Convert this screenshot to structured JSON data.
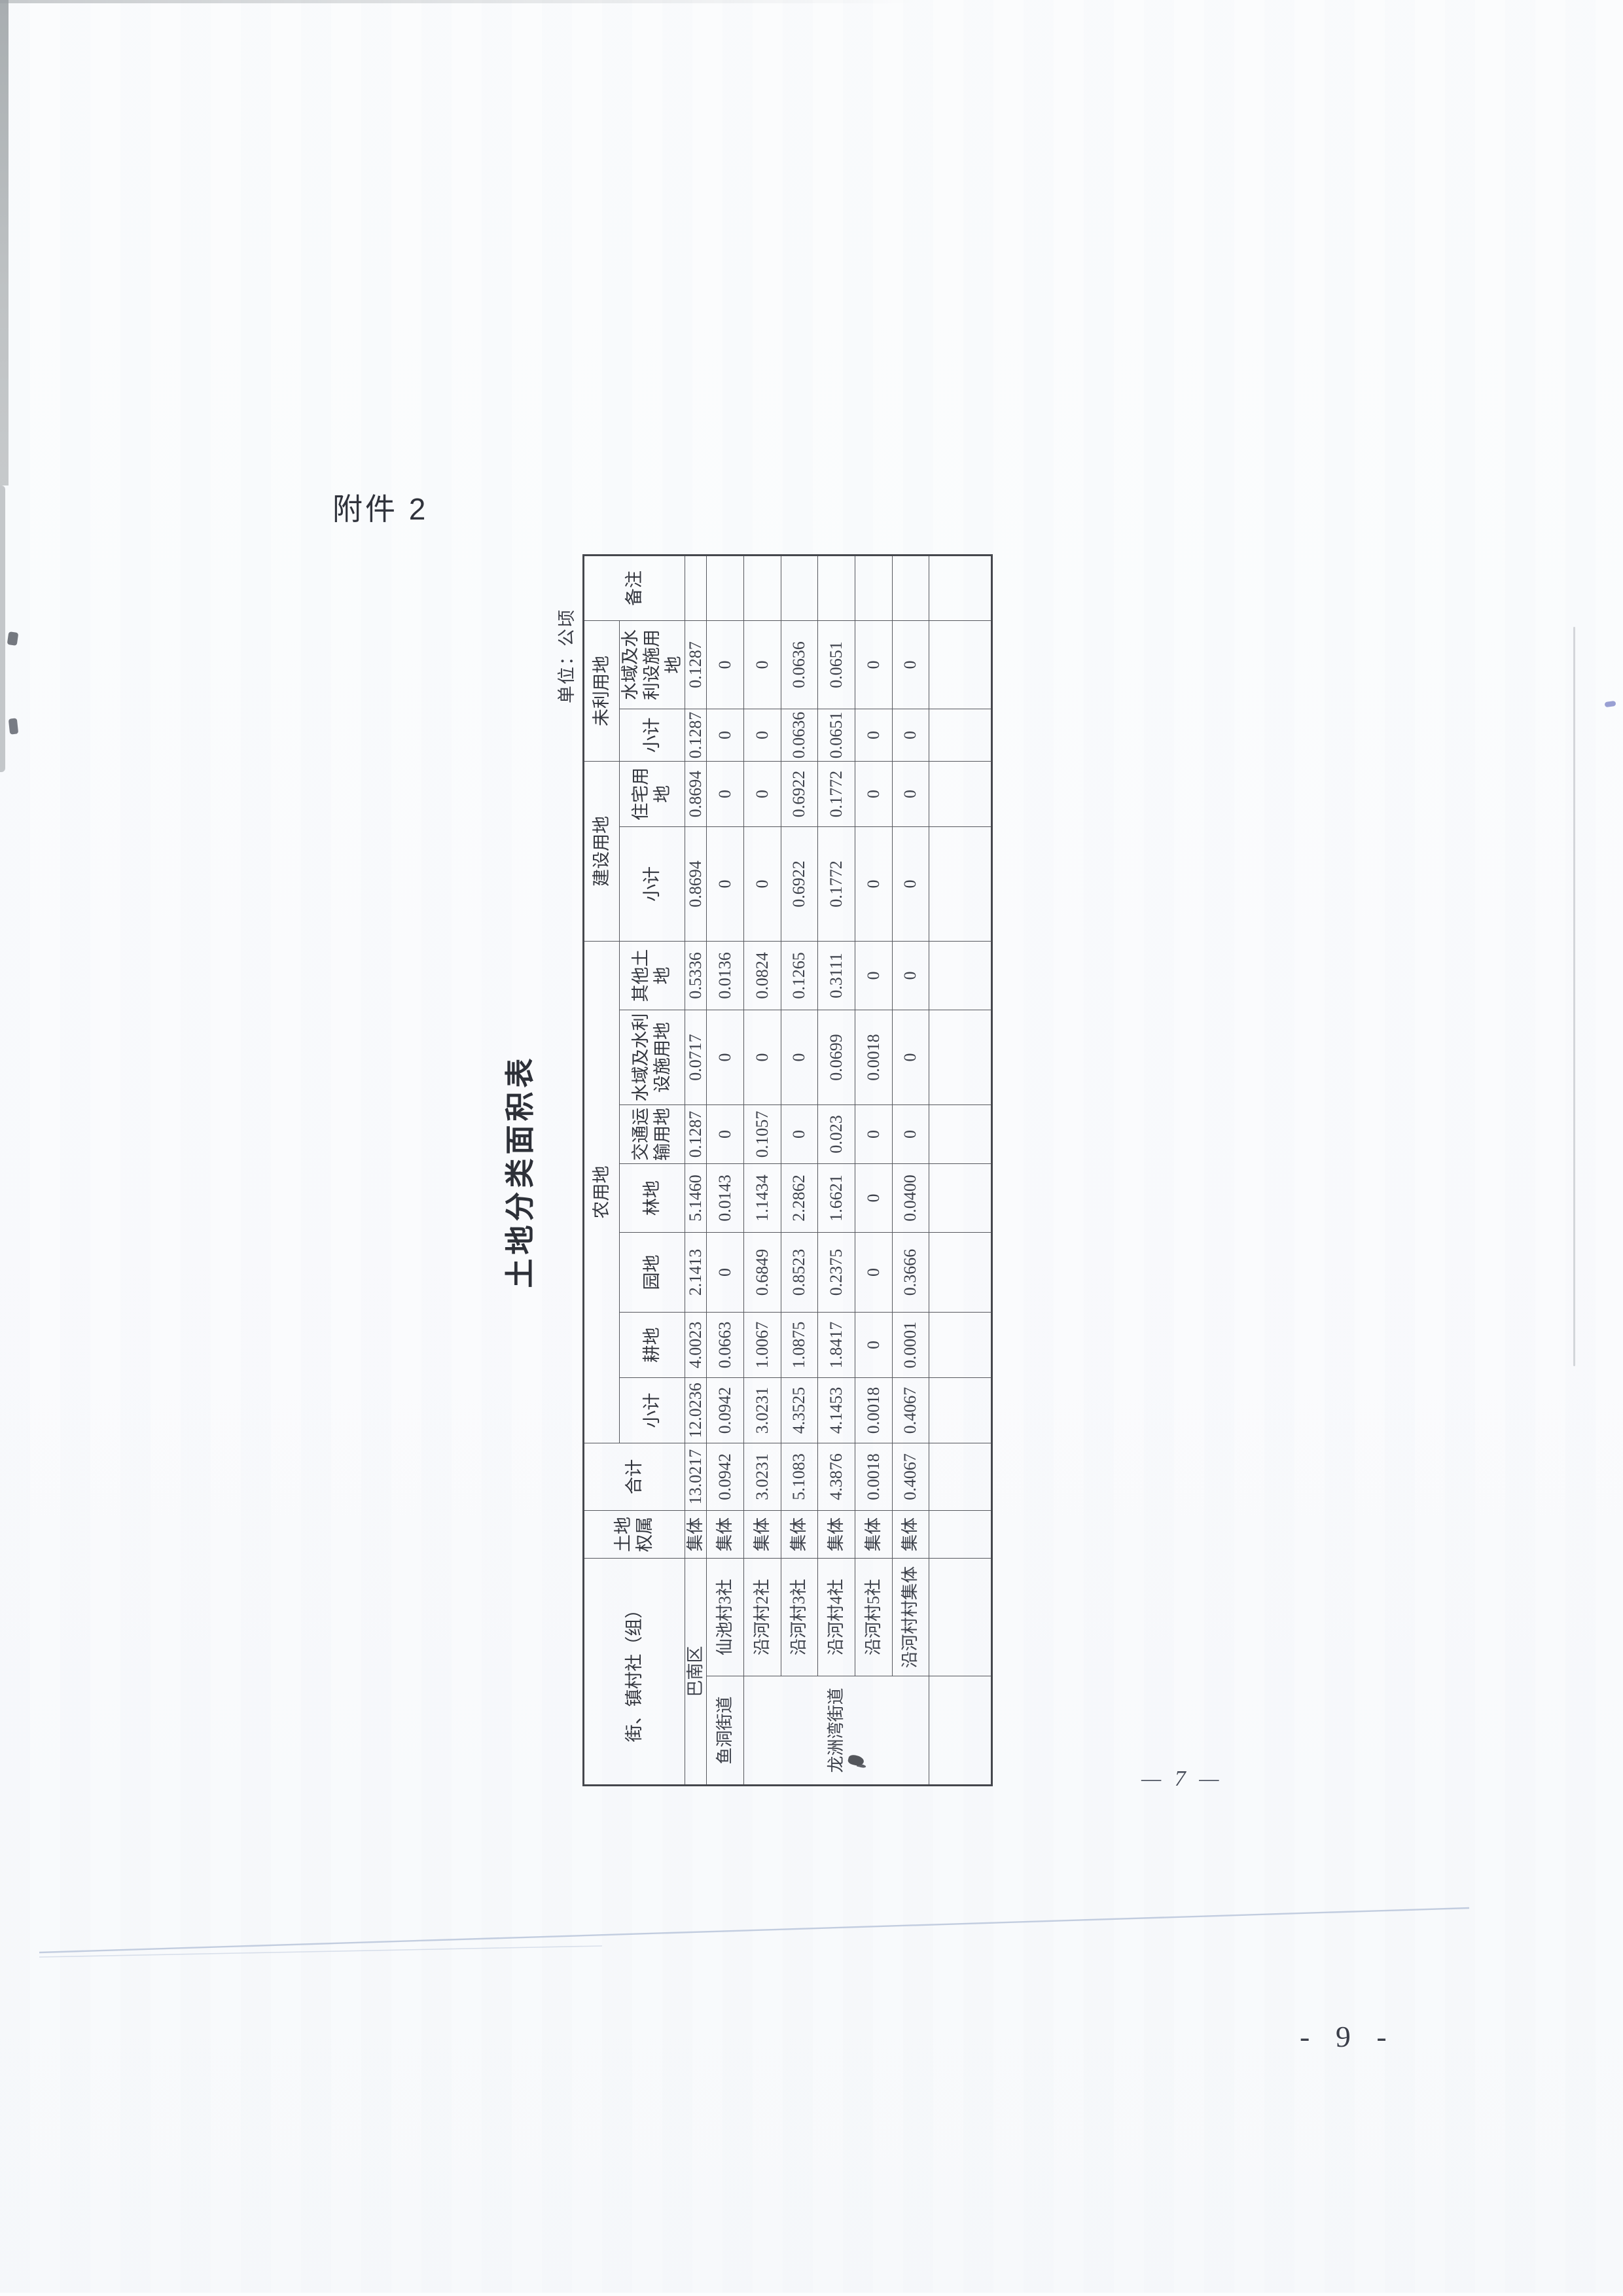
{
  "page": {
    "attachment_label": "附件 2",
    "unit_note": "单位：公顷",
    "inner_page_number": "— 7 —",
    "outer_page_number": "- 9 -"
  },
  "table": {
    "title": "土地分类面积表",
    "headers": {
      "region": "街、镇村社（组）",
      "ownership": "土地权属",
      "total": "合计",
      "agri_group": "农用地",
      "agri_subtotal": "小计",
      "cultivated": "耕地",
      "garden": "园地",
      "forest": "林地",
      "transport": "交通运输用地",
      "agri_water": "水域及水利设施用地",
      "other_land": "其他土地",
      "constr_group": "建设用地",
      "constr_subtotal": "小计",
      "residential": "住宅用地",
      "unused_group": "未利用地",
      "unused_subtotal": "小计",
      "unused_water": "水域及水利设施用地",
      "remarks": "备注"
    },
    "rows": [
      {
        "street": "",
        "village": "巴南区",
        "ownership": "集体",
        "total": "13.0217",
        "agri_subtotal": "12.0236",
        "cultivated": "4.0023",
        "garden": "2.1413",
        "forest": "5.1460",
        "transport": "0.1287",
        "agri_water": "0.0717",
        "other_land": "0.5336",
        "constr_subtotal": "0.8694",
        "residential": "0.8694",
        "unused_subtotal": "0.1287",
        "unused_water": "0.1287",
        "remarks": ""
      },
      {
        "street": "鱼洞街道",
        "village": "仙池村3社",
        "ownership": "集体",
        "total": "0.0942",
        "agri_subtotal": "0.0942",
        "cultivated": "0.0663",
        "garden": "0",
        "forest": "0.0143",
        "transport": "0",
        "agri_water": "0",
        "other_land": "0.0136",
        "constr_subtotal": "0",
        "residential": "0",
        "unused_subtotal": "0",
        "unused_water": "0",
        "remarks": ""
      },
      {
        "street": "龙洲湾街道",
        "village": "沿河村2社",
        "ownership": "集体",
        "total": "3.0231",
        "agri_subtotal": "3.0231",
        "cultivated": "1.0067",
        "garden": "0.6849",
        "forest": "1.1434",
        "transport": "0.1057",
        "agri_water": "0",
        "other_land": "0.0824",
        "constr_subtotal": "0",
        "residential": "0",
        "unused_subtotal": "0",
        "unused_water": "0",
        "remarks": ""
      },
      {
        "street": "",
        "village": "沿河村3社",
        "ownership": "集体",
        "total": "5.1083",
        "agri_subtotal": "4.3525",
        "cultivated": "1.0875",
        "garden": "0.8523",
        "forest": "2.2862",
        "transport": "0",
        "agri_water": "0",
        "other_land": "0.1265",
        "constr_subtotal": "0.6922",
        "residential": "0.6922",
        "unused_subtotal": "0.0636",
        "unused_water": "0.0636",
        "remarks": ""
      },
      {
        "street": "",
        "village": "沿河村4社",
        "ownership": "集体",
        "total": "4.3876",
        "agri_subtotal": "4.1453",
        "cultivated": "1.8417",
        "garden": "0.2375",
        "forest": "1.6621",
        "transport": "0.023",
        "agri_water": "0.0699",
        "other_land": "0.3111",
        "constr_subtotal": "0.1772",
        "residential": "0.1772",
        "unused_subtotal": "0.0651",
        "unused_water": "0.0651",
        "remarks": ""
      },
      {
        "street": "",
        "village": "沿河村5社",
        "ownership": "集体",
        "total": "0.0018",
        "agri_subtotal": "0.0018",
        "cultivated": "0",
        "garden": "0",
        "forest": "0",
        "transport": "0",
        "agri_water": "0.0018",
        "other_land": "0",
        "constr_subtotal": "0",
        "residential": "0",
        "unused_subtotal": "0",
        "unused_water": "0",
        "remarks": ""
      },
      {
        "street": "",
        "village": "沿河村村集体",
        "ownership": "集体",
        "total": "0.4067",
        "agri_subtotal": "0.4067",
        "cultivated": "0.0001",
        "garden": "0.3666",
        "forest": "0.0400",
        "transport": "0",
        "agri_water": "0",
        "other_land": "0",
        "constr_subtotal": "0",
        "residential": "0",
        "unused_subtotal": "0",
        "unused_water": "0",
        "remarks": ""
      },
      {
        "street": "",
        "village": "",
        "ownership": "",
        "total": "",
        "agri_subtotal": "",
        "cultivated": "",
        "garden": "",
        "forest": "",
        "transport": "",
        "agri_water": "",
        "other_land": "",
        "constr_subtotal": "",
        "residential": "",
        "unused_subtotal": "",
        "unused_water": "",
        "remarks": ""
      }
    ]
  }
}
